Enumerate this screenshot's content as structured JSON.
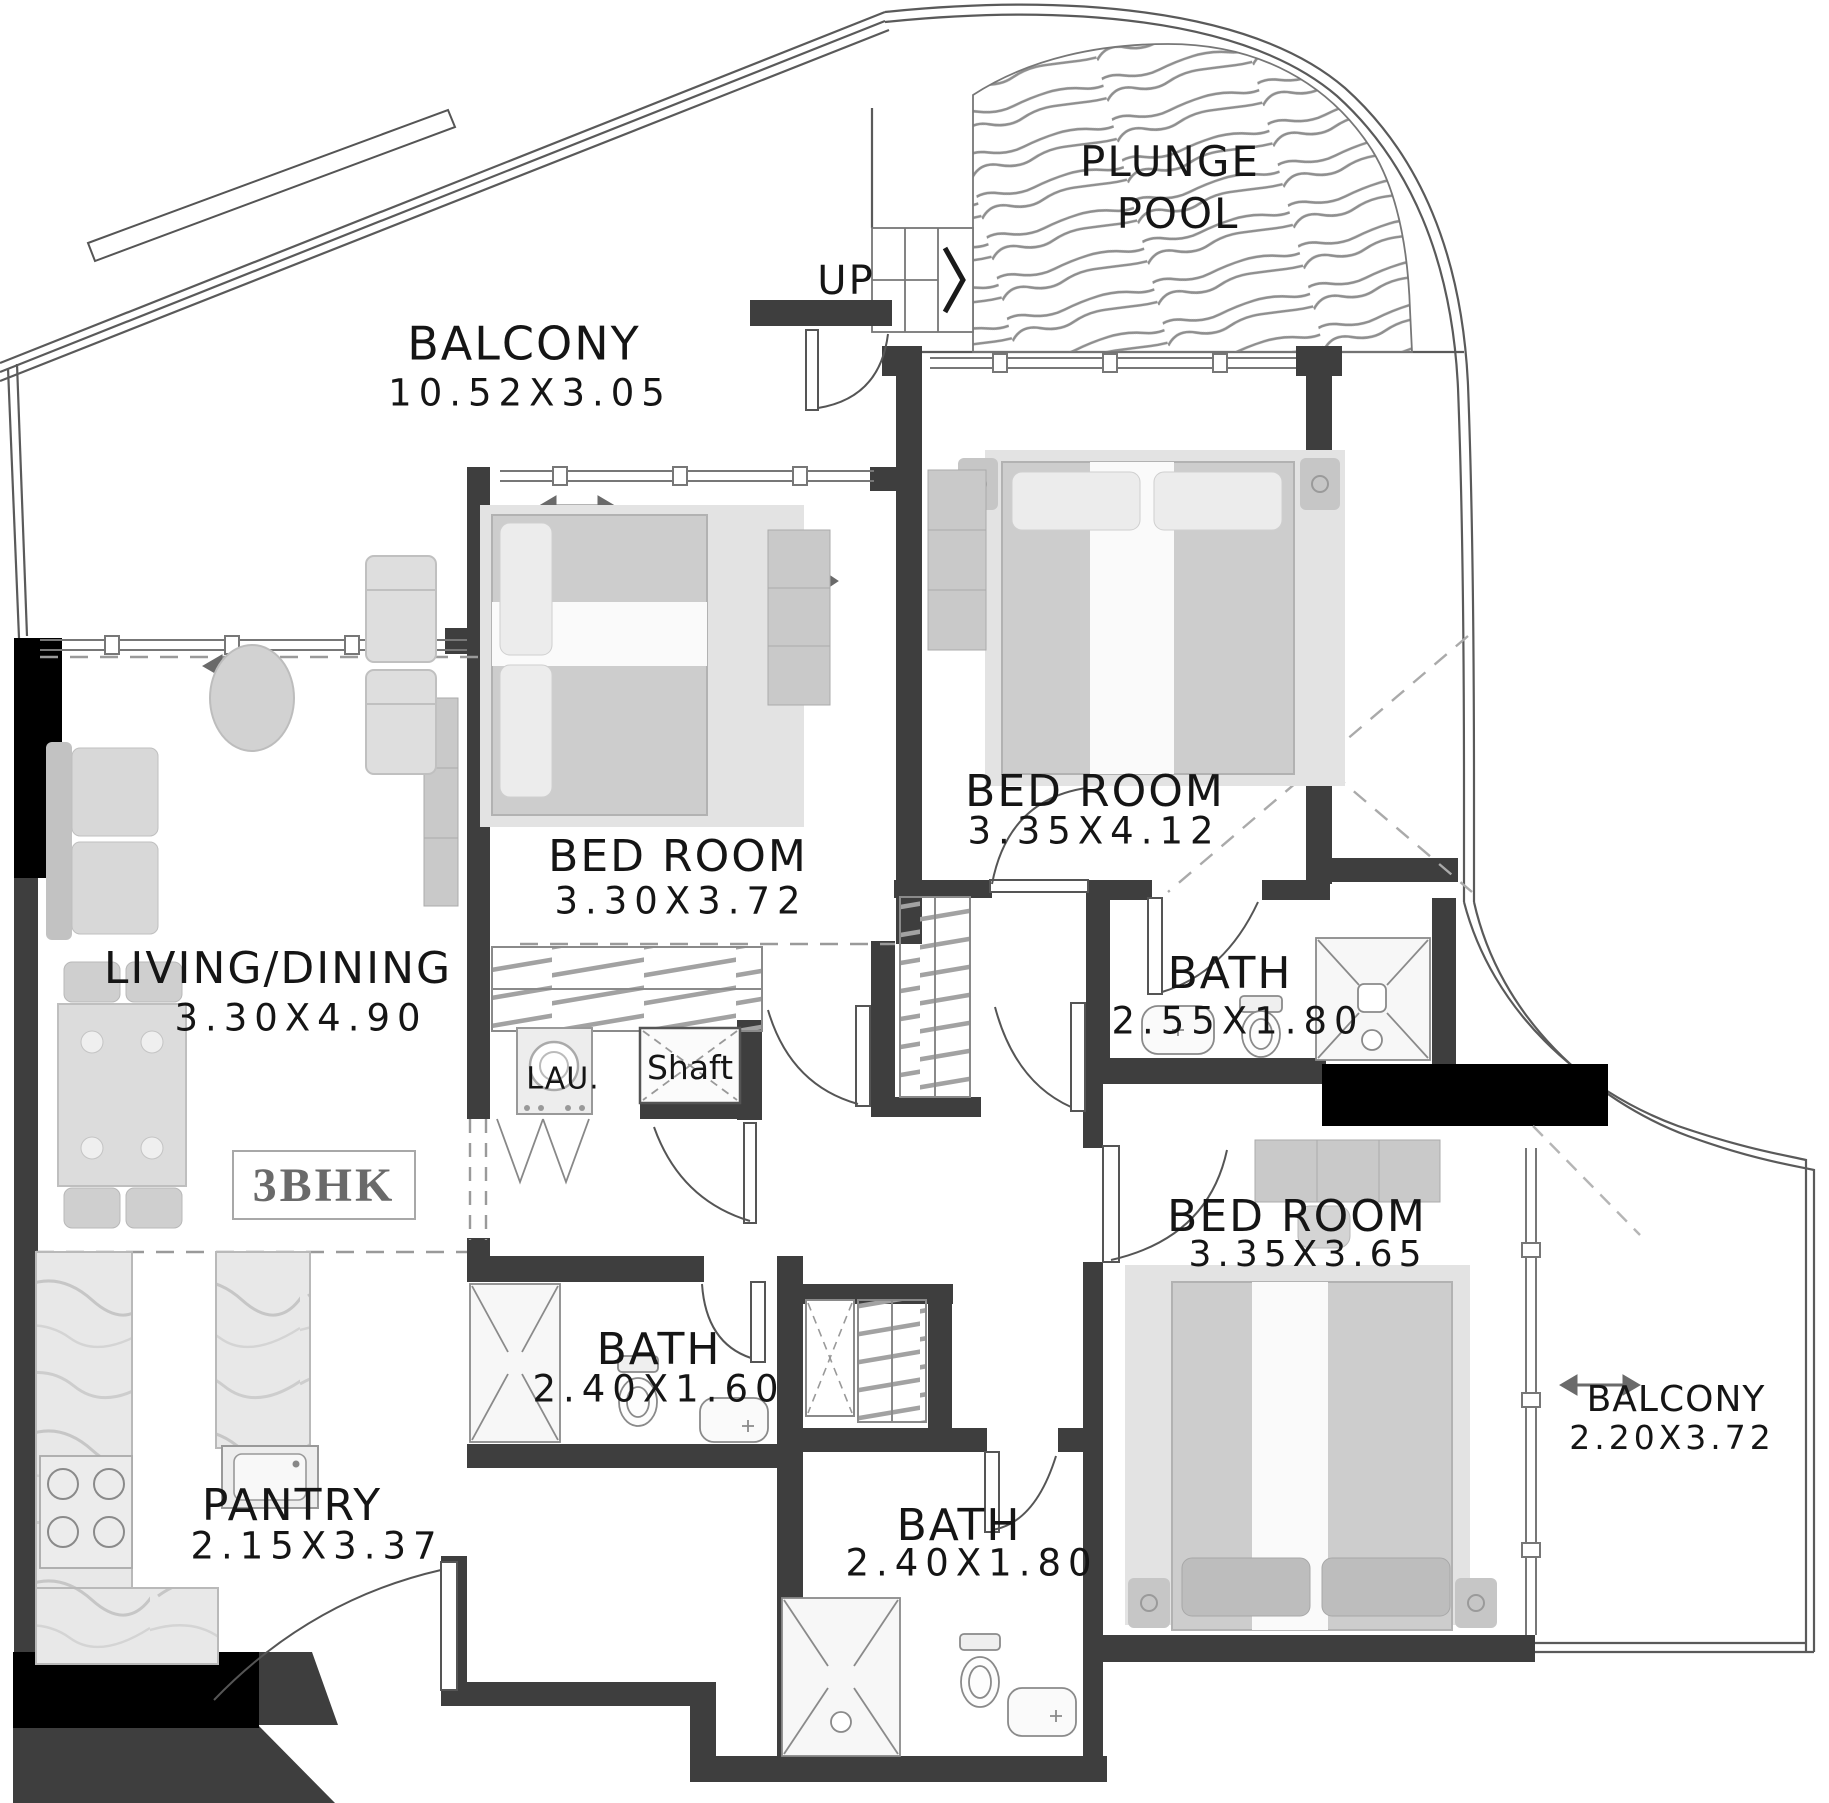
{
  "plan": {
    "unit_label": "3BHK",
    "labels": {
      "plunge_pool_line1": "PLUNGE",
      "plunge_pool_line2": "POOL",
      "up": "UP",
      "balcony_top": {
        "name": "BALCONY",
        "dims": "10.52X3.05"
      },
      "bedroom_1": {
        "name": "BED ROOM",
        "dims": "3.30X3.72"
      },
      "bedroom_2": {
        "name": "BED ROOM",
        "dims": "3.35X4.12"
      },
      "bedroom_3": {
        "name": "BED ROOM",
        "dims": "3.35X3.65"
      },
      "living_dining": {
        "name": "LIVING/DINING",
        "dims": "3.30X4.90"
      },
      "bath_1": {
        "name": "BATH",
        "dims": "2.55X1.80"
      },
      "bath_2": {
        "name": "BATH",
        "dims": "2.40X1.60"
      },
      "bath_3": {
        "name": "BATH",
        "dims": "2.40X1.80"
      },
      "pantry": {
        "name": "PANTRY",
        "dims": "2.15X3.37"
      },
      "balcony_right": {
        "name": "BALCONY",
        "dims": "2.20X3.72"
      },
      "laundry": "LAU.",
      "shaft": "Shaft"
    },
    "colors": {
      "wall": "#3e3e3e",
      "column": "#000000",
      "text": "#151515",
      "furniture": "#cdcdcd",
      "unit_tag_text": "#6a6a6a",
      "pool_wave": "#8f8f8f",
      "background": "#ffffff"
    }
  }
}
